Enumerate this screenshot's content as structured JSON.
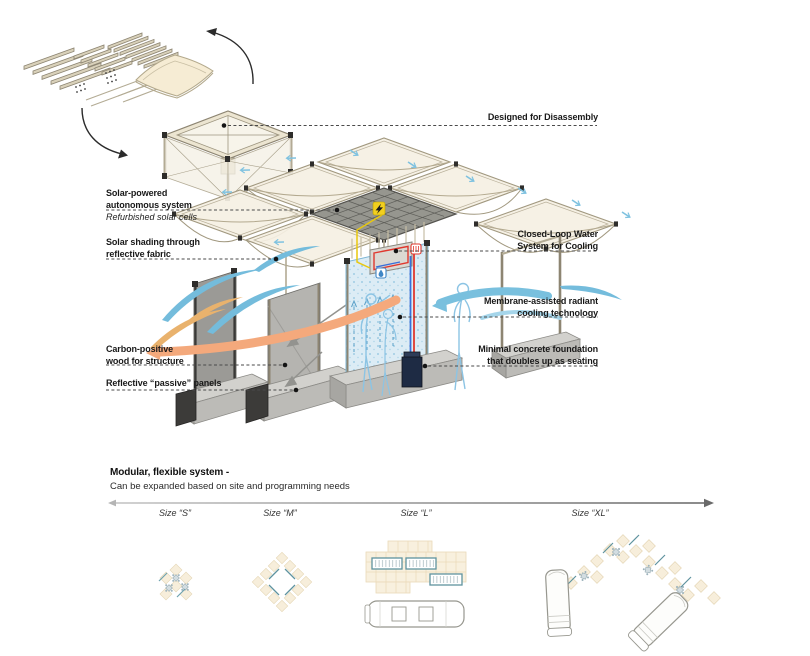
{
  "annotations": {
    "left": [
      {
        "id": "solar-system",
        "lines": [
          "Solar-powered",
          "autonomous system"
        ],
        "note": "Refurbished solar cells"
      },
      {
        "id": "solar-shading",
        "lines": [
          "Solar shading through",
          "reflective fabric"
        ]
      },
      {
        "id": "carbon-wood",
        "lines": [
          "Carbon-positive",
          "wood for structure"
        ]
      },
      {
        "id": "reflective-panels",
        "lines": [
          "Reflective “passive” panels"
        ]
      }
    ],
    "right": [
      {
        "id": "disassembly",
        "lines": [
          "Designed for Disassembly"
        ]
      },
      {
        "id": "closed-loop",
        "lines": [
          "Closed-Loop Water",
          "System for Cooling"
        ]
      },
      {
        "id": "membrane",
        "lines": [
          "Membrane-assisted radiant",
          "cooling technology"
        ]
      },
      {
        "id": "foundation",
        "lines": [
          "Minimal concrete foundation",
          "that doubles up as seating"
        ]
      }
    ]
  },
  "footer": {
    "title": "Modular, flexible system -",
    "subtitle": "Can be expanded based on site and programming needs",
    "sizes": [
      "Size “S”",
      "Size “M”",
      "Size “L”",
      "Size “XL”"
    ]
  },
  "icons": {
    "solar_badge": "lightning-bolt",
    "radiator_badge": "heat-coil",
    "water_badge": "water-droplet"
  },
  "colors": {
    "wood": "#cfc6ae",
    "fabric": "#f5f0e3",
    "solar_panel": "#96968f",
    "concrete": "#c9c8c4",
    "cool_air": "#74bcdc",
    "warm_air": "#f4a97c",
    "membrane": "#dcecf5",
    "wire_yellow": "#e8c80f",
    "pipe_red": "#e03a30",
    "pipe_blue": "#3a6fd8"
  }
}
